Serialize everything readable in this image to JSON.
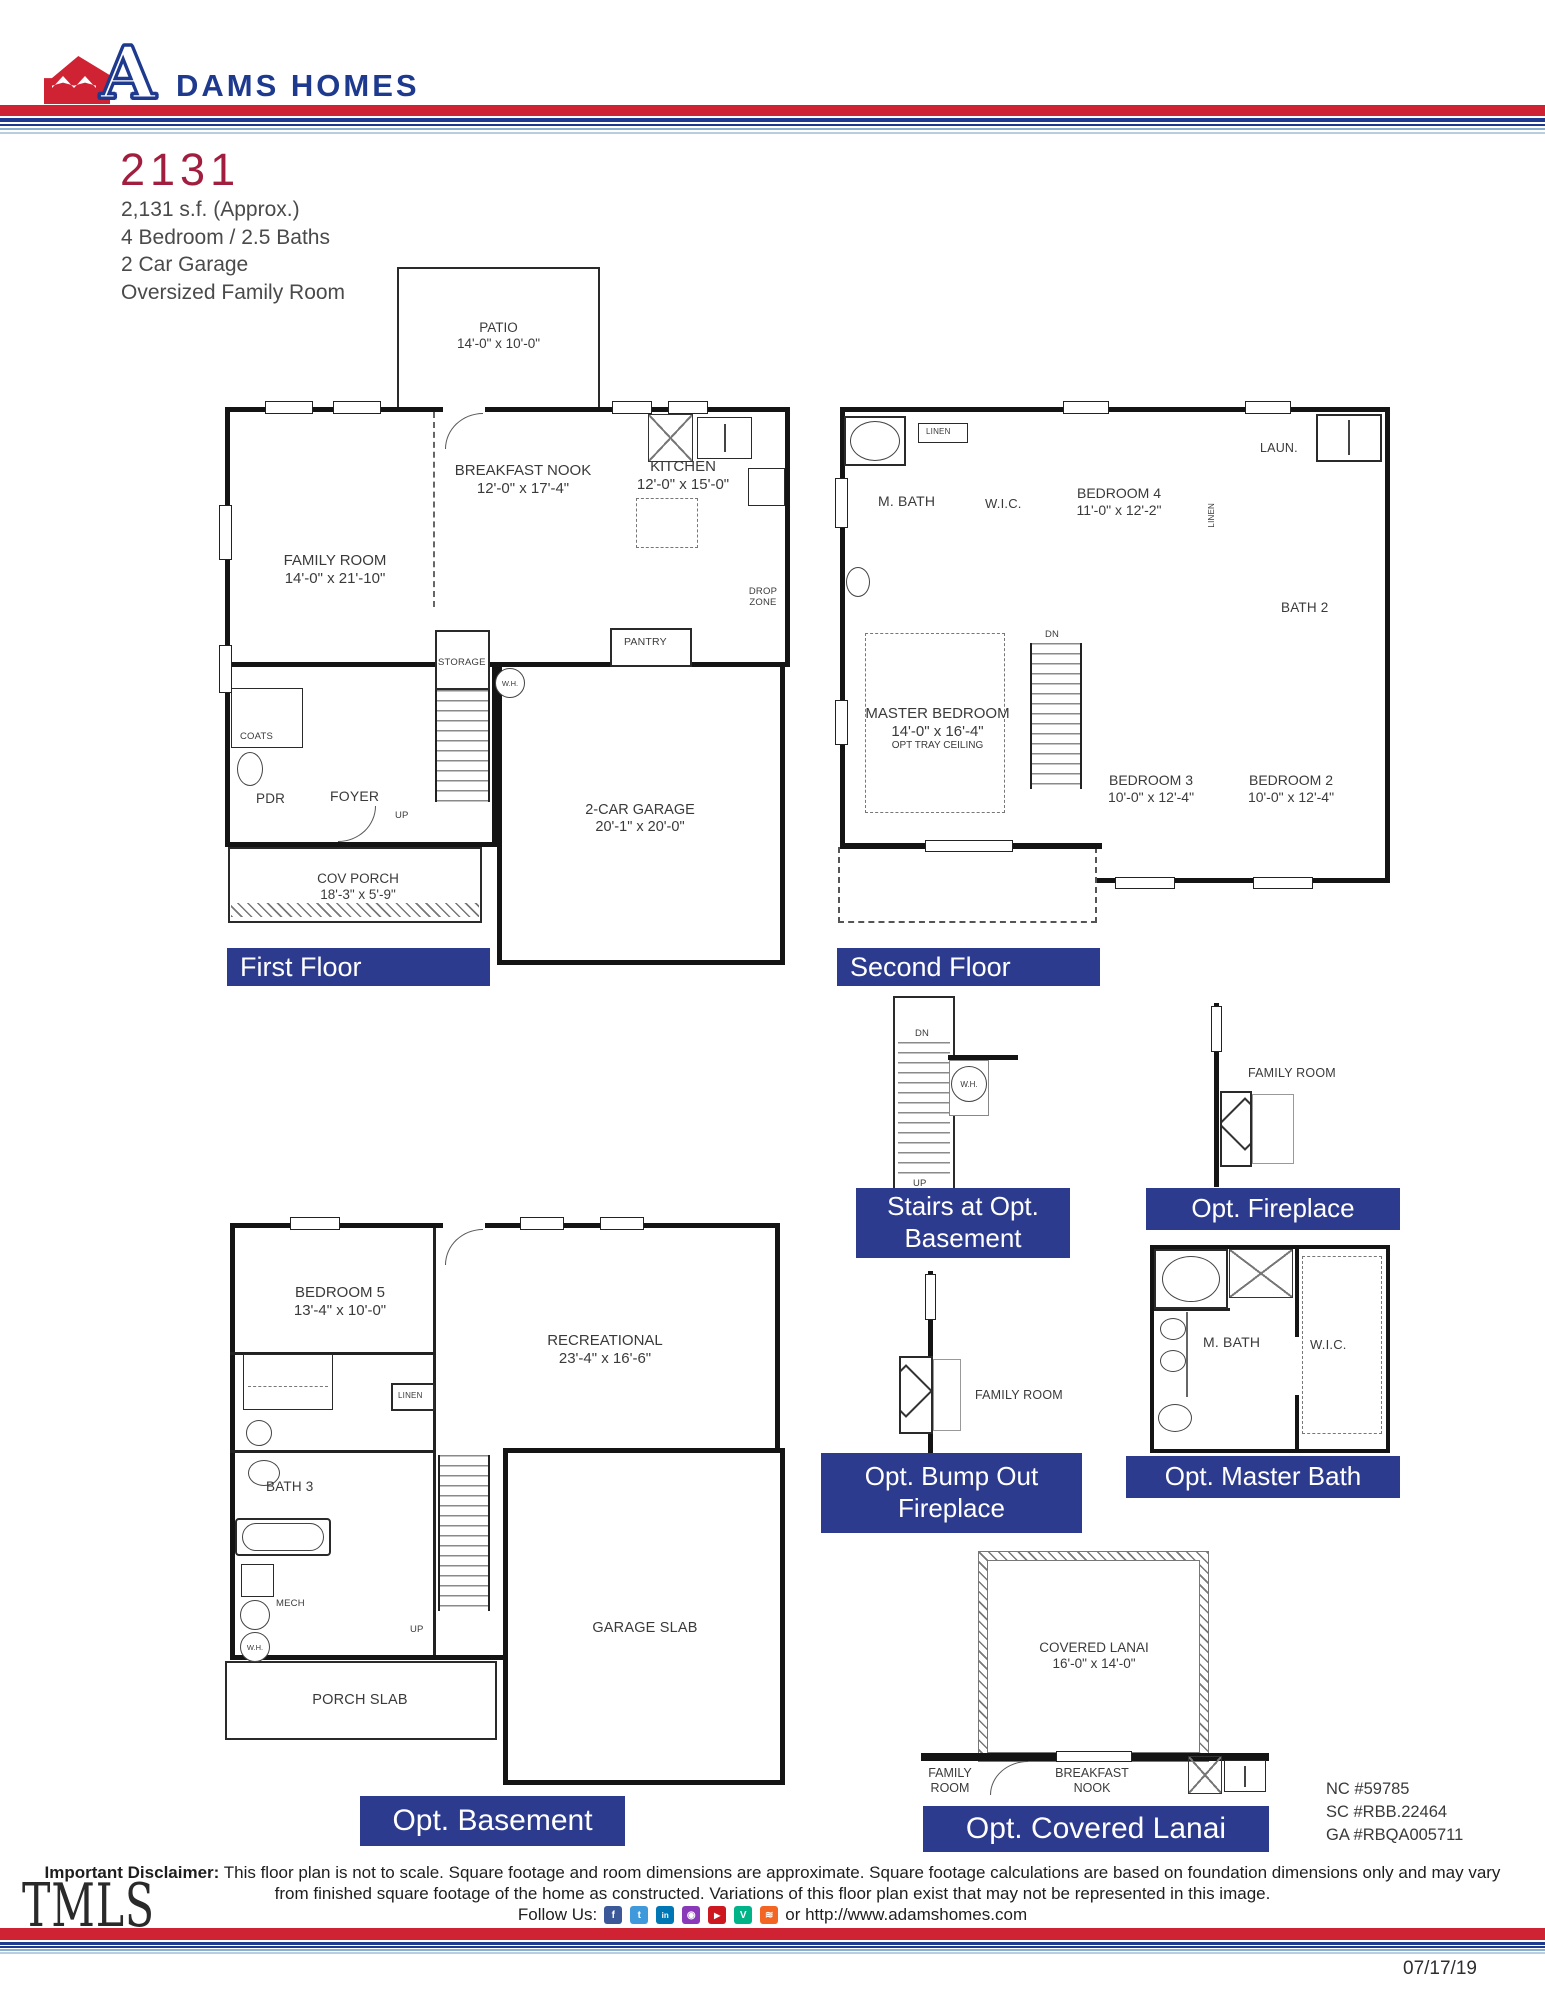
{
  "colors": {
    "label_navy": "#2d3b8e",
    "brand_navy": "#1e3a8f",
    "brand_red": "#cf2233",
    "plan_maroon": "#a11e3e",
    "stripe_light_blue": "#8ab0d0",
    "text_gray": "#4a4a4a",
    "wall_black": "#141414"
  },
  "header": {
    "brand_a": "A",
    "brand_name": "DAMS HOMES"
  },
  "plan_info": {
    "number": "2131",
    "line1": "2,131 s.f. (Approx.)",
    "line2": "4 Bedroom / 2.5 Baths",
    "line3": "2 Car Garage",
    "line4": "Oversized Family Room"
  },
  "first_floor": {
    "label": "First Floor",
    "patio": {
      "name": "PATIO",
      "dims": "14'-0\" x 10'-0\""
    },
    "breakfast_nook": {
      "name": "BREAKFAST NOOK",
      "dims": "12'-0\" x 17'-4\""
    },
    "kitchen": {
      "name": "KITCHEN",
      "dims": "12'-0\" x 15'-0\""
    },
    "family_room": {
      "name": "FAMILY ROOM",
      "dims": "14'-0\" x 21'-10\""
    },
    "garage": {
      "name": "2-CAR GARAGE",
      "dims": "20'-1\" x 20'-0\""
    },
    "cov_porch": {
      "name": "COV PORCH",
      "dims": "18'-3\" x 5'-9\""
    },
    "drop_zone": "DROP ZONE",
    "pantry": "PANTRY",
    "storage": "STORAGE",
    "wh": "W.H.",
    "coats": "COATS",
    "pdr": "PDR",
    "foyer": "FOYER",
    "up": "UP"
  },
  "second_floor": {
    "label": "Second Floor",
    "master": {
      "name": "MASTER BEDROOM",
      "dims": "14'-0\" x 16'-4\"",
      "note": "OPT TRAY CEILING"
    },
    "bedroom4": {
      "name": "BEDROOM 4",
      "dims": "11'-0\" x 12'-2\""
    },
    "bedroom3": {
      "name": "BEDROOM 3",
      "dims": "10'-0\" x 12'-4\""
    },
    "bedroom2": {
      "name": "BEDROOM 2",
      "dims": "10'-0\" x 12'-4\""
    },
    "mbath": "M. BATH",
    "wic": "W.I.C.",
    "linen1": "LINEN",
    "linen2": "LINEN",
    "laundry": "LAUN.",
    "bath2": "BATH 2",
    "dn": "DN"
  },
  "stairs_opt_basement": {
    "label_line1": "Stairs at Opt.",
    "label_line2": "Basement",
    "dn": "DN",
    "up": "UP",
    "wh": "W.H."
  },
  "opt_fireplace": {
    "label": "Opt. Fireplace",
    "family_room": "FAMILY ROOM"
  },
  "opt_master_bath": {
    "label": "Opt. Master Bath",
    "mbath": "M. BATH",
    "wic": "W.I.C."
  },
  "opt_bump_out": {
    "label_line1": "Opt. Bump Out",
    "label_line2": "Fireplace",
    "family_room": "FAMILY ROOM"
  },
  "basement": {
    "label": "Opt. Basement",
    "bedroom5": {
      "name": "BEDROOM 5",
      "dims": "13'-4\" x 10'-0\""
    },
    "recreational": {
      "name": "RECREATIONAL",
      "dims": "23'-4\" x 16'-6\""
    },
    "linen": "LINEN",
    "bath3": "BATH 3",
    "mech": "MECH",
    "wh": "W.H.",
    "up": "UP",
    "garage_slab": "GARAGE SLAB",
    "porch_slab": "PORCH SLAB"
  },
  "covered_lanai": {
    "label": "Opt. Covered Lanai",
    "name": "COVERED LANAI",
    "dims": "16'-0\" x 14'-0\"",
    "family_room": "FAMILY ROOM",
    "breakfast_nook": "BREAKFAST NOOK"
  },
  "licenses": [
    "NC #59785",
    "SC #RBB.22464",
    "GA #RBQA005711"
  ],
  "footer": {
    "disclaimer_label": "Important Disclaimer:",
    "disclaimer_text": "This floor plan is not to scale. Square footage and room dimensions are approximate. Square footage calculations are based on foundation dimensions only and may vary from finished square footage of the home as constructed. Variations of this floor plan exist that may not be represented in this image.",
    "follow_us": "Follow Us:",
    "website": "or http://www.adamshomes.com",
    "date": "07/17/19",
    "tmls": "TMLS",
    "social": [
      {
        "name": "facebook-icon",
        "glyph": "f",
        "color": "#3b5998"
      },
      {
        "name": "twitter-icon",
        "glyph": "t",
        "color": "#4099db"
      },
      {
        "name": "linkedin-icon",
        "glyph": "in",
        "color": "#0077b5"
      },
      {
        "name": "instagram-icon",
        "glyph": "◉",
        "color": "#8a3ab9"
      },
      {
        "name": "youtube-icon",
        "glyph": "▶",
        "color": "#cc181e"
      },
      {
        "name": "vine-icon",
        "glyph": "V",
        "color": "#00b488"
      },
      {
        "name": "rss-icon",
        "glyph": "≋",
        "color": "#f26522"
      }
    ]
  }
}
